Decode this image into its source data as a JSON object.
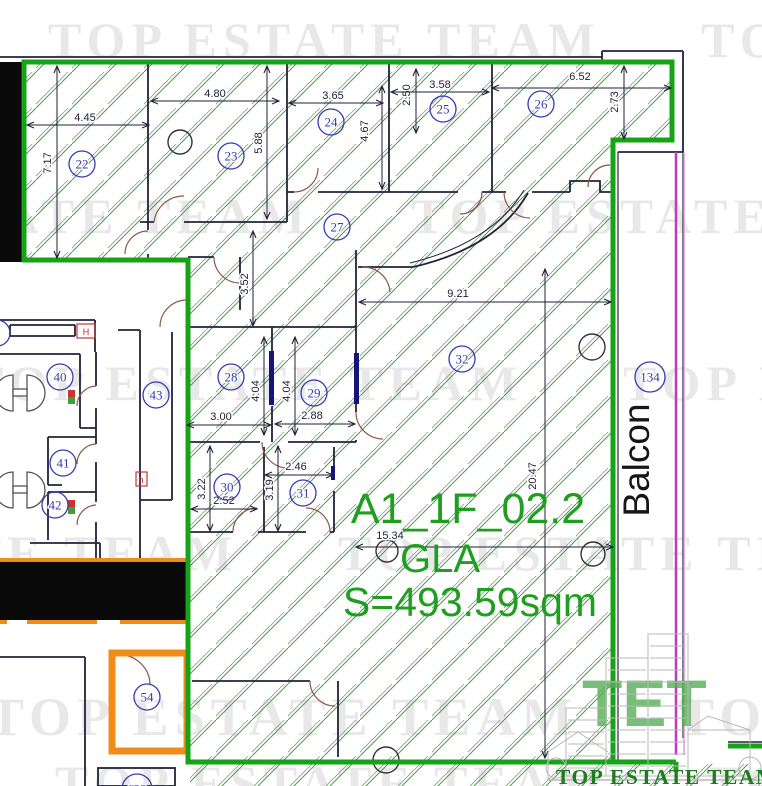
{
  "watermark": {
    "text": "TOP ESTATE TEAM",
    "rows": [
      {
        "x": 48,
        "y": 57,
        "size": 50
      },
      {
        "x": -242,
        "y": 233,
        "size": 50
      },
      {
        "x": -30,
        "y": 400,
        "size": 50
      },
      {
        "x": -315,
        "y": 570,
        "size": 50
      },
      {
        "x": -12,
        "y": 735,
        "size": 54
      },
      {
        "x": 55,
        "y": 800,
        "size": 50
      }
    ]
  },
  "unit": {
    "id": "A1_1F_02.2",
    "type": "GLA",
    "area": "S=493.59sqm"
  },
  "balcony": {
    "label": "Balcon"
  },
  "logo": {
    "monogram": "TET",
    "caption": "TOP ESTATE TEAM"
  },
  "rooms": [
    {
      "n": "22",
      "x": 82,
      "y": 164
    },
    {
      "n": "23",
      "x": 231,
      "y": 156
    },
    {
      "n": "24",
      "x": 331,
      "y": 122
    },
    {
      "n": "25",
      "x": 443,
      "y": 109
    },
    {
      "n": "26",
      "x": 541,
      "y": 104
    },
    {
      "n": "27",
      "x": 337,
      "y": 227
    },
    {
      "n": "28",
      "x": 231,
      "y": 377
    },
    {
      "n": "29",
      "x": 314,
      "y": 393
    },
    {
      "n": "30",
      "x": 227,
      "y": 487
    },
    {
      "n": "31",
      "x": 303,
      "y": 493
    },
    {
      "n": "32",
      "x": 462,
      "y": 359
    },
    {
      "n": "40",
      "x": 60,
      "y": 377
    },
    {
      "n": "41",
      "x": 63,
      "y": 463
    },
    {
      "n": "42",
      "x": 55,
      "y": 505
    },
    {
      "n": "43",
      "x": 156,
      "y": 395
    },
    {
      "n": "54",
      "x": 147,
      "y": 697
    },
    {
      "n": "134",
      "x": 650,
      "y": 377
    },
    {
      "n": "122",
      "x": 137,
      "y": 789
    },
    {
      "n": "9",
      "x": -3,
      "y": 333
    }
  ],
  "dimensions": [
    {
      "t": "4.45",
      "x": 85,
      "y": 121,
      "rot": false,
      "line": [
        28,
        125,
        148,
        125
      ]
    },
    {
      "t": "7.17",
      "x": 51,
      "y": 163,
      "rot": true,
      "line": [
        57,
        67,
        57,
        257
      ]
    },
    {
      "t": "4.80",
      "x": 215,
      "y": 97,
      "rot": false,
      "line": [
        152,
        101,
        278,
        101
      ]
    },
    {
      "t": "5.88",
      "x": 262,
      "y": 143,
      "rot": true,
      "line": [
        267,
        67,
        267,
        218
      ]
    },
    {
      "t": "3.65",
      "x": 333,
      "y": 99,
      "rot": false,
      "line": [
        290,
        103,
        382,
        103
      ]
    },
    {
      "t": "4.67",
      "x": 368,
      "y": 131,
      "rot": true,
      "line": [
        382,
        87,
        382,
        188
      ]
    },
    {
      "t": "2.50",
      "x": 410,
      "y": 95,
      "rot": true,
      "line": [
        416,
        70,
        416,
        132
      ]
    },
    {
      "t": "3.58",
      "x": 440,
      "y": 88,
      "rot": false,
      "line": [
        392,
        92,
        488,
        92
      ]
    },
    {
      "t": "6.52",
      "x": 580,
      "y": 80,
      "rot": false,
      "line": [
        493,
        88,
        670,
        88
      ]
    },
    {
      "t": "2.73",
      "x": 618,
      "y": 102,
      "rot": true,
      "line": [
        624,
        67,
        624,
        138
      ]
    },
    {
      "t": "3.52",
      "x": 248,
      "y": 284,
      "rot": true,
      "line": [
        253,
        232,
        253,
        325
      ]
    },
    {
      "t": "9.21",
      "x": 458,
      "y": 297,
      "rot": false,
      "line": [
        360,
        302,
        610,
        302
      ]
    },
    {
      "t": "4.04",
      "x": 259,
      "y": 391,
      "rot": true,
      "line": [
        264,
        338,
        264,
        434
      ]
    },
    {
      "t": "4.04",
      "x": 290,
      "y": 391,
      "rot": true,
      "line": [
        295,
        338,
        295,
        434
      ]
    },
    {
      "t": "3.00",
      "x": 221,
      "y": 420,
      "rot": false,
      "line": [
        188,
        425,
        270,
        425
      ]
    },
    {
      "t": "2.88",
      "x": 312,
      "y": 419,
      "rot": false,
      "line": [
        276,
        424,
        354,
        424
      ]
    },
    {
      "t": "3.22",
      "x": 205,
      "y": 489,
      "rot": true,
      "line": [
        210,
        447,
        210,
        530
      ]
    },
    {
      "t": "2.52",
      "x": 224,
      "y": 504,
      "rot": false,
      "line": [
        192,
        509,
        256,
        509
      ]
    },
    {
      "t": "2.46",
      "x": 296,
      "y": 470,
      "rot": false,
      "line": [
        266,
        475,
        332,
        475
      ]
    },
    {
      "t": "3.19",
      "x": 273,
      "y": 490,
      "rot": true,
      "line": [
        278,
        447,
        278,
        530
      ]
    },
    {
      "t": "15.34",
      "x": 390,
      "y": 539,
      "rot": false,
      "line": [
        357,
        547,
        612,
        547
      ]
    },
    {
      "t": "20.47",
      "x": 536,
      "y": 476,
      "rot": true,
      "line": [
        545,
        270,
        545,
        757
      ]
    }
  ],
  "annotations": [
    {
      "text": "H",
      "x": 86,
      "y": 335
    },
    {
      "text": "h",
      "x": 141,
      "y": 483
    }
  ],
  "colors": {
    "boundary_green": "#17a317",
    "hatch_green": "#4f9a4f",
    "highlight_orange": "#ef8c1a",
    "magenta": "#c238c2",
    "room_blue": "#3a3ab0",
    "label_green": "#1f9e1f"
  }
}
